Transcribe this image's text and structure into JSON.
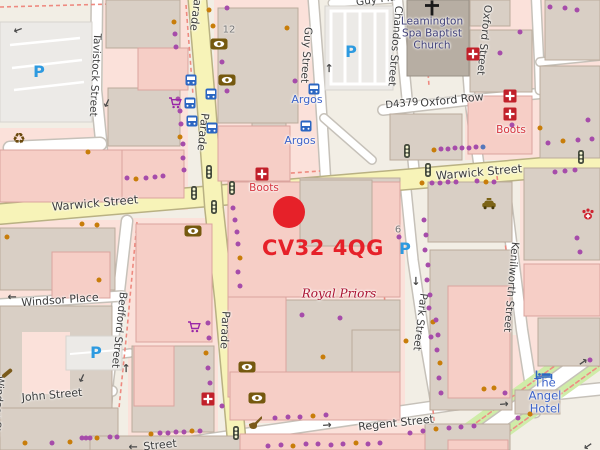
{
  "overlay": {
    "postcode": "CV32 4QG",
    "marker_color": "#e62129",
    "marker_x": 289,
    "marker_y": 212,
    "text_x": 262,
    "text_y": 236
  },
  "map": {
    "colors": {
      "purple_dot": "#a64caa",
      "orange_dot": "#c87d0a",
      "blue_dot": "#5577bb",
      "road_yellow": "#f7f3b8",
      "road_white": "#ffffff",
      "building_taupe": "#d9cfc5",
      "building_pink": "#f6cec6",
      "landuse_pink": "#fbe1da",
      "poi_blue": "#3d63c9",
      "poi_red": "#d5353f",
      "church_label": "#42427a",
      "royal_priors": "#aa1130",
      "street_label": "#3d3d3d",
      "parking_blue": "#2d9ae0"
    },
    "street_labels": [
      {
        "name": "parade-label-top",
        "text": "Parade",
        "x": 196,
        "y": 12,
        "rot": 97,
        "size": 11
      },
      {
        "name": "parade-label-mid",
        "text": "Parade",
        "x": 203,
        "y": 132,
        "rot": 96,
        "size": 11
      },
      {
        "name": "parade-label-bottom",
        "text": "Parade",
        "x": 225,
        "y": 330,
        "rot": 93,
        "size": 11
      },
      {
        "name": "tavistock-street-label",
        "text": "Tavistock Street",
        "x": 95,
        "y": 75,
        "rot": 93,
        "size": 10.5
      },
      {
        "name": "bedford-street-label",
        "text": "Bedford Street",
        "x": 119,
        "y": 330,
        "rot": 96,
        "size": 10.5
      },
      {
        "name": "windsor-street-label",
        "text": "Windsor Str",
        "x": -2,
        "y": 406,
        "rot": 94,
        "size": 10.5
      },
      {
        "name": "windsor-place-label",
        "text": "Windsor Place",
        "x": 60,
        "y": 300,
        "rot": -4,
        "size": 11
      },
      {
        "name": "john-street-label",
        "text": "John Street",
        "x": 52,
        "y": 395,
        "rot": -5,
        "size": 11
      },
      {
        "name": "guy-street-label",
        "text": "Guy Street",
        "x": 306,
        "y": 55,
        "rot": 94,
        "size": 10.5
      },
      {
        "name": "guy-place-label",
        "text": "Guy Place",
        "x": 382,
        "y": -1,
        "rot": -8,
        "size": 10.5
      },
      {
        "name": "chandos-street-label",
        "text": "Chandos Street",
        "x": 395,
        "y": 46,
        "rot": 95,
        "size": 10.5
      },
      {
        "name": "oxford-street-label",
        "text": "Oxford Street",
        "x": 484,
        "y": 40,
        "rot": 96,
        "size": 10.5
      },
      {
        "name": "oxford-row-label",
        "text": "Oxford Row",
        "x": 452,
        "y": 100,
        "rot": -6,
        "size": 11
      },
      {
        "name": "road-ref-d4379",
        "text": "D4379",
        "x": 402,
        "y": 104,
        "rot": -6,
        "size": 10
      },
      {
        "name": "warwick-street-label-west",
        "text": "Warwick Street",
        "x": 95,
        "y": 203,
        "rot": -5,
        "size": 11.5
      },
      {
        "name": "warwick-street-label-east",
        "text": "Warwick Street",
        "x": 479,
        "y": 172,
        "rot": -5,
        "size": 11.5
      },
      {
        "name": "kenilworth-street-label",
        "text": "Kenilworth Street",
        "x": 511,
        "y": 287,
        "rot": 95,
        "size": 10.5
      },
      {
        "name": "park-street-label",
        "text": "Park Street",
        "x": 420,
        "y": 322,
        "rot": 97,
        "size": 10.5
      },
      {
        "name": "regent-street-label",
        "text": "Regent Street",
        "x": 396,
        "y": 423,
        "rot": -6,
        "size": 11
      },
      {
        "name": "regent-street-label-west",
        "text": "Street",
        "x": 160,
        "y": 445,
        "rot": -6,
        "size": 11
      }
    ],
    "poi_labels": [
      {
        "name": "baptist-church-label",
        "text": "Leamington\nSpa Baptist\nChurch",
        "x": 432,
        "y": 34,
        "color": "#42427a",
        "size": 10.5
      },
      {
        "name": "argos-label-1",
        "text": "Argos",
        "x": 307,
        "y": 100,
        "color": "#3d63c9",
        "size": 11
      },
      {
        "name": "argos-label-2",
        "text": "Argos",
        "x": 300,
        "y": 141,
        "color": "#3d63c9",
        "size": 11
      },
      {
        "name": "boots-label-west",
        "text": "Boots",
        "x": 264,
        "y": 189,
        "color": "#d5353f",
        "size": 10.5
      },
      {
        "name": "boots-label-east",
        "text": "Boots",
        "x": 511,
        "y": 131,
        "color": "#d5353f",
        "size": 10.5
      },
      {
        "name": "royal-priors-label",
        "text": "Royal Priors",
        "x": 339,
        "y": 294,
        "color": "#aa1130",
        "size": 12,
        "serif": true,
        "italic": true
      },
      {
        "name": "angel-hotel-label",
        "text": "The Angel\nHotel",
        "x": 545,
        "y": 396,
        "color": "#3d63c9",
        "size": 11.5
      }
    ],
    "house_numbers": [
      {
        "text": "12",
        "x": 229,
        "y": 30
      },
      {
        "text": "6",
        "x": 398,
        "y": 230
      }
    ],
    "icons": [
      {
        "type": "parking",
        "x": 39,
        "y": 72
      },
      {
        "type": "parking",
        "x": 351,
        "y": 52
      },
      {
        "type": "parking",
        "x": 405,
        "y": 249
      },
      {
        "type": "parking",
        "x": 96,
        "y": 353
      },
      {
        "type": "bus-stop",
        "x": 191,
        "y": 80
      },
      {
        "type": "bus-stop",
        "x": 211,
        "y": 94
      },
      {
        "type": "bus-stop",
        "x": 190,
        "y": 103
      },
      {
        "type": "bus-stop",
        "x": 192,
        "y": 121
      },
      {
        "type": "bus-stop",
        "x": 212,
        "y": 128
      },
      {
        "type": "bus-stop",
        "x": 314,
        "y": 89
      },
      {
        "type": "bus-stop",
        "x": 306,
        "y": 126
      },
      {
        "type": "traffic-light",
        "x": 209,
        "y": 172
      },
      {
        "type": "traffic-light",
        "x": 232,
        "y": 188
      },
      {
        "type": "traffic-light",
        "x": 194,
        "y": 193
      },
      {
        "type": "traffic-light",
        "x": 214,
        "y": 207
      },
      {
        "type": "traffic-light",
        "x": 407,
        "y": 151
      },
      {
        "type": "traffic-light",
        "x": 428,
        "y": 170
      },
      {
        "type": "traffic-light",
        "x": 581,
        "y": 157
      },
      {
        "type": "traffic-light",
        "x": 236,
        "y": 433
      },
      {
        "type": "pharmacy",
        "x": 262,
        "y": 174
      },
      {
        "type": "pharmacy",
        "x": 473,
        "y": 54
      },
      {
        "type": "pharmacy",
        "x": 510,
        "y": 96
      },
      {
        "type": "pharmacy",
        "x": 510,
        "y": 114
      },
      {
        "type": "pharmacy",
        "x": 208,
        "y": 399
      },
      {
        "type": "eye",
        "x": 219,
        "y": 44
      },
      {
        "type": "eye",
        "x": 227,
        "y": 80
      },
      {
        "type": "eye",
        "x": 193,
        "y": 231
      },
      {
        "type": "eye",
        "x": 247,
        "y": 367
      },
      {
        "type": "eye",
        "x": 257,
        "y": 398
      },
      {
        "type": "shopping-cart",
        "x": 175,
        "y": 103
      },
      {
        "type": "shopping-cart",
        "x": 194,
        "y": 327
      },
      {
        "type": "recycling",
        "x": 19,
        "y": 139
      },
      {
        "type": "taxi",
        "x": 489,
        "y": 204
      },
      {
        "type": "vet",
        "x": 588,
        "y": 214
      },
      {
        "type": "bed",
        "x": 544,
        "y": 375
      },
      {
        "type": "church-cross",
        "x": 432,
        "y": 8
      },
      {
        "type": "pipe",
        "x": 255,
        "y": 423
      },
      {
        "type": "tool",
        "x": 7,
        "y": 373
      }
    ],
    "arrows": [
      {
        "x": 12,
        "y": 297,
        "rot": 180
      },
      {
        "x": 133,
        "y": 447,
        "rot": 180
      },
      {
        "x": 327,
        "y": 425,
        "rot": -5
      },
      {
        "x": 504,
        "y": 404,
        "rot": -5
      },
      {
        "x": 416,
        "y": 281,
        "rot": 90
      },
      {
        "x": 126,
        "y": 368,
        "rot": -90
      },
      {
        "x": 329,
        "y": 68,
        "rot": -90
      },
      {
        "x": 82,
        "y": 378,
        "rot": 115
      },
      {
        "x": 583,
        "y": 362,
        "rot": -35
      },
      {
        "x": 588,
        "y": 446,
        "rot": 145
      },
      {
        "x": 107,
        "y": 103,
        "rot": 115
      },
      {
        "x": 18,
        "y": 30,
        "rot": 160
      }
    ],
    "dots": [
      [
        174,
        22,
        "o"
      ],
      [
        175,
        34,
        "p"
      ],
      [
        176,
        47,
        "p"
      ],
      [
        178,
        99,
        "p"
      ],
      [
        180,
        111,
        "p"
      ],
      [
        181,
        124,
        "p"
      ],
      [
        180,
        137,
        "o"
      ],
      [
        183,
        144,
        "p"
      ],
      [
        209,
        10,
        "o"
      ],
      [
        213,
        26,
        "o"
      ],
      [
        222,
        62,
        "p"
      ],
      [
        225,
        78,
        "p"
      ],
      [
        227,
        91,
        "p"
      ],
      [
        295,
        81,
        "p"
      ],
      [
        227,
        8,
        "p"
      ],
      [
        287,
        28,
        "o"
      ],
      [
        550,
        7,
        "p"
      ],
      [
        565,
        8,
        "p"
      ],
      [
        577,
        10,
        "p"
      ],
      [
        500,
        53,
        "p"
      ],
      [
        520,
        32,
        "p"
      ],
      [
        548,
        143,
        "p"
      ],
      [
        563,
        141,
        "o"
      ],
      [
        578,
        140,
        "p"
      ],
      [
        592,
        139,
        "p"
      ],
      [
        588,
        120,
        "p"
      ],
      [
        512,
        125,
        "p"
      ],
      [
        540,
        128,
        "o"
      ],
      [
        434,
        150,
        "o"
      ],
      [
        441,
        149,
        "p"
      ],
      [
        448,
        149,
        "p"
      ],
      [
        455,
        148,
        "p"
      ],
      [
        462,
        148,
        "p"
      ],
      [
        469,
        148,
        "p"
      ],
      [
        476,
        147,
        "p"
      ],
      [
        483,
        147,
        "b"
      ],
      [
        422,
        183,
        "o"
      ],
      [
        432,
        183,
        "p"
      ],
      [
        440,
        183,
        "p"
      ],
      [
        448,
        182,
        "p"
      ],
      [
        456,
        182,
        "p"
      ],
      [
        477,
        181,
        "p"
      ],
      [
        486,
        182,
        "o"
      ],
      [
        494,
        182,
        "p"
      ],
      [
        555,
        172,
        "p"
      ],
      [
        565,
        171,
        "p"
      ],
      [
        575,
        170,
        "p"
      ],
      [
        424,
        220,
        "p"
      ],
      [
        426,
        235,
        "p"
      ],
      [
        425,
        250,
        "p"
      ],
      [
        428,
        265,
        "p"
      ],
      [
        427,
        280,
        "p"
      ],
      [
        430,
        295,
        "p"
      ],
      [
        429,
        308,
        "p"
      ],
      [
        433,
        322,
        "o"
      ],
      [
        431,
        337,
        "p"
      ],
      [
        399,
        237,
        "p"
      ],
      [
        436,
        320,
        "p"
      ],
      [
        438,
        335,
        "p"
      ],
      [
        437,
        350,
        "p"
      ],
      [
        440,
        363,
        "o"
      ],
      [
        439,
        378,
        "p"
      ],
      [
        441,
        393,
        "p"
      ],
      [
        577,
        238,
        "p"
      ],
      [
        580,
        252,
        "p"
      ],
      [
        590,
        360,
        "p"
      ],
      [
        127,
        178,
        "p"
      ],
      [
        136,
        179,
        "o"
      ],
      [
        146,
        178,
        "p"
      ],
      [
        155,
        177,
        "p"
      ],
      [
        163,
        176,
        "p"
      ],
      [
        88,
        152,
        "o"
      ],
      [
        183,
        158,
        "p"
      ],
      [
        184,
        170,
        "p"
      ],
      [
        7,
        237,
        "o"
      ],
      [
        82,
        224,
        "o"
      ],
      [
        97,
        225,
        "o"
      ],
      [
        99,
        280,
        "o"
      ],
      [
        233,
        208,
        "p"
      ],
      [
        235,
        220,
        "p"
      ],
      [
        237,
        232,
        "p"
      ],
      [
        238,
        244,
        "p"
      ],
      [
        240,
        258,
        "o"
      ],
      [
        238,
        272,
        "p"
      ],
      [
        240,
        286,
        "p"
      ],
      [
        302,
        315,
        "p"
      ],
      [
        340,
        318,
        "p"
      ],
      [
        323,
        357,
        "o"
      ],
      [
        406,
        341,
        "o"
      ],
      [
        208,
        323,
        "p"
      ],
      [
        209,
        338,
        "p"
      ],
      [
        206,
        353,
        "o"
      ],
      [
        208,
        368,
        "p"
      ],
      [
        210,
        383,
        "p"
      ],
      [
        222,
        406,
        "p"
      ],
      [
        275,
        418,
        "p"
      ],
      [
        288,
        417,
        "p"
      ],
      [
        300,
        417,
        "p"
      ],
      [
        313,
        416,
        "o"
      ],
      [
        326,
        415,
        "p"
      ],
      [
        151,
        434,
        "o"
      ],
      [
        160,
        433,
        "p"
      ],
      [
        168,
        433,
        "p"
      ],
      [
        176,
        432,
        "p"
      ],
      [
        184,
        432,
        "p"
      ],
      [
        192,
        431,
        "o"
      ],
      [
        200,
        431,
        "p"
      ],
      [
        268,
        446,
        "p"
      ],
      [
        281,
        445,
        "p"
      ],
      [
        293,
        446,
        "o"
      ],
      [
        306,
        444,
        "p"
      ],
      [
        318,
        444,
        "p"
      ],
      [
        331,
        445,
        "p"
      ],
      [
        343,
        444,
        "p"
      ],
      [
        356,
        443,
        "o"
      ],
      [
        368,
        444,
        "p"
      ],
      [
        380,
        443,
        "p"
      ],
      [
        410,
        433,
        "p"
      ],
      [
        423,
        431,
        "p"
      ],
      [
        436,
        429,
        "o"
      ],
      [
        449,
        428,
        "p"
      ],
      [
        461,
        427,
        "p"
      ],
      [
        474,
        426,
        "p"
      ],
      [
        484,
        389,
        "o"
      ],
      [
        494,
        388,
        "o"
      ],
      [
        505,
        393,
        "p"
      ],
      [
        518,
        418,
        "p"
      ],
      [
        530,
        414,
        "o"
      ],
      [
        25,
        443,
        "o"
      ],
      [
        52,
        443,
        "p"
      ],
      [
        70,
        442,
        "o"
      ],
      [
        82,
        438,
        "p"
      ],
      [
        86,
        438,
        "p"
      ],
      [
        90,
        438,
        "p"
      ],
      [
        97,
        438,
        "o"
      ],
      [
        110,
        437,
        "p"
      ],
      [
        117,
        437,
        "p"
      ]
    ]
  }
}
